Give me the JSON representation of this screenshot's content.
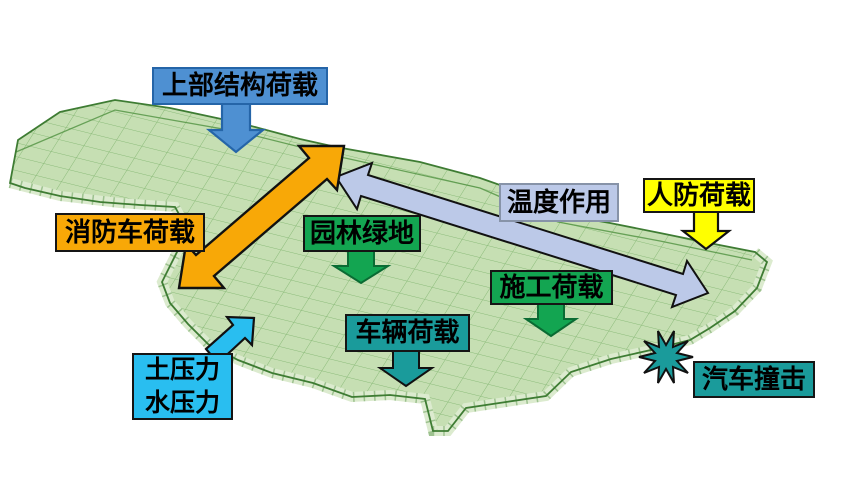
{
  "diagram": {
    "labels": {
      "upper_structure_load": "上部结构荷载",
      "fire_truck_load": "消防车荷载",
      "garden_green_space": "园林绿地",
      "temperature_action": "温度作用",
      "civil_defense_load": "人防荷载",
      "construction_load": "施工荷载",
      "vehicle_load": "车辆荷载",
      "earth_pressure": "土压力",
      "water_pressure": "水压力",
      "car_impact": "汽车撞击"
    },
    "colors": {
      "blue_box": "#4E90D2",
      "blue_box_border": "#2565A8",
      "blue_arrow": "#4E90D2",
      "orange": "#F8A807",
      "green": "#13A551",
      "teal": "#1A9B9B",
      "yellow": "#FFFF00",
      "cyan": "#29BEF0",
      "periwinkle": "#BCC9E8",
      "periwinkle_border": "#8793A8",
      "structure_fill": "#C6DFB3",
      "structure_side": "#DCEBCF",
      "structure_line": "#4F9140",
      "structure_edge": "#3E7C33",
      "outline_black": "#111111",
      "background": "#FFFFFF"
    },
    "icons": {
      "impact_starburst": "impact-starburst-icon",
      "down_arrow": "down-arrow-icon",
      "double_arrow": "double-headed-arrow-icon"
    }
  }
}
